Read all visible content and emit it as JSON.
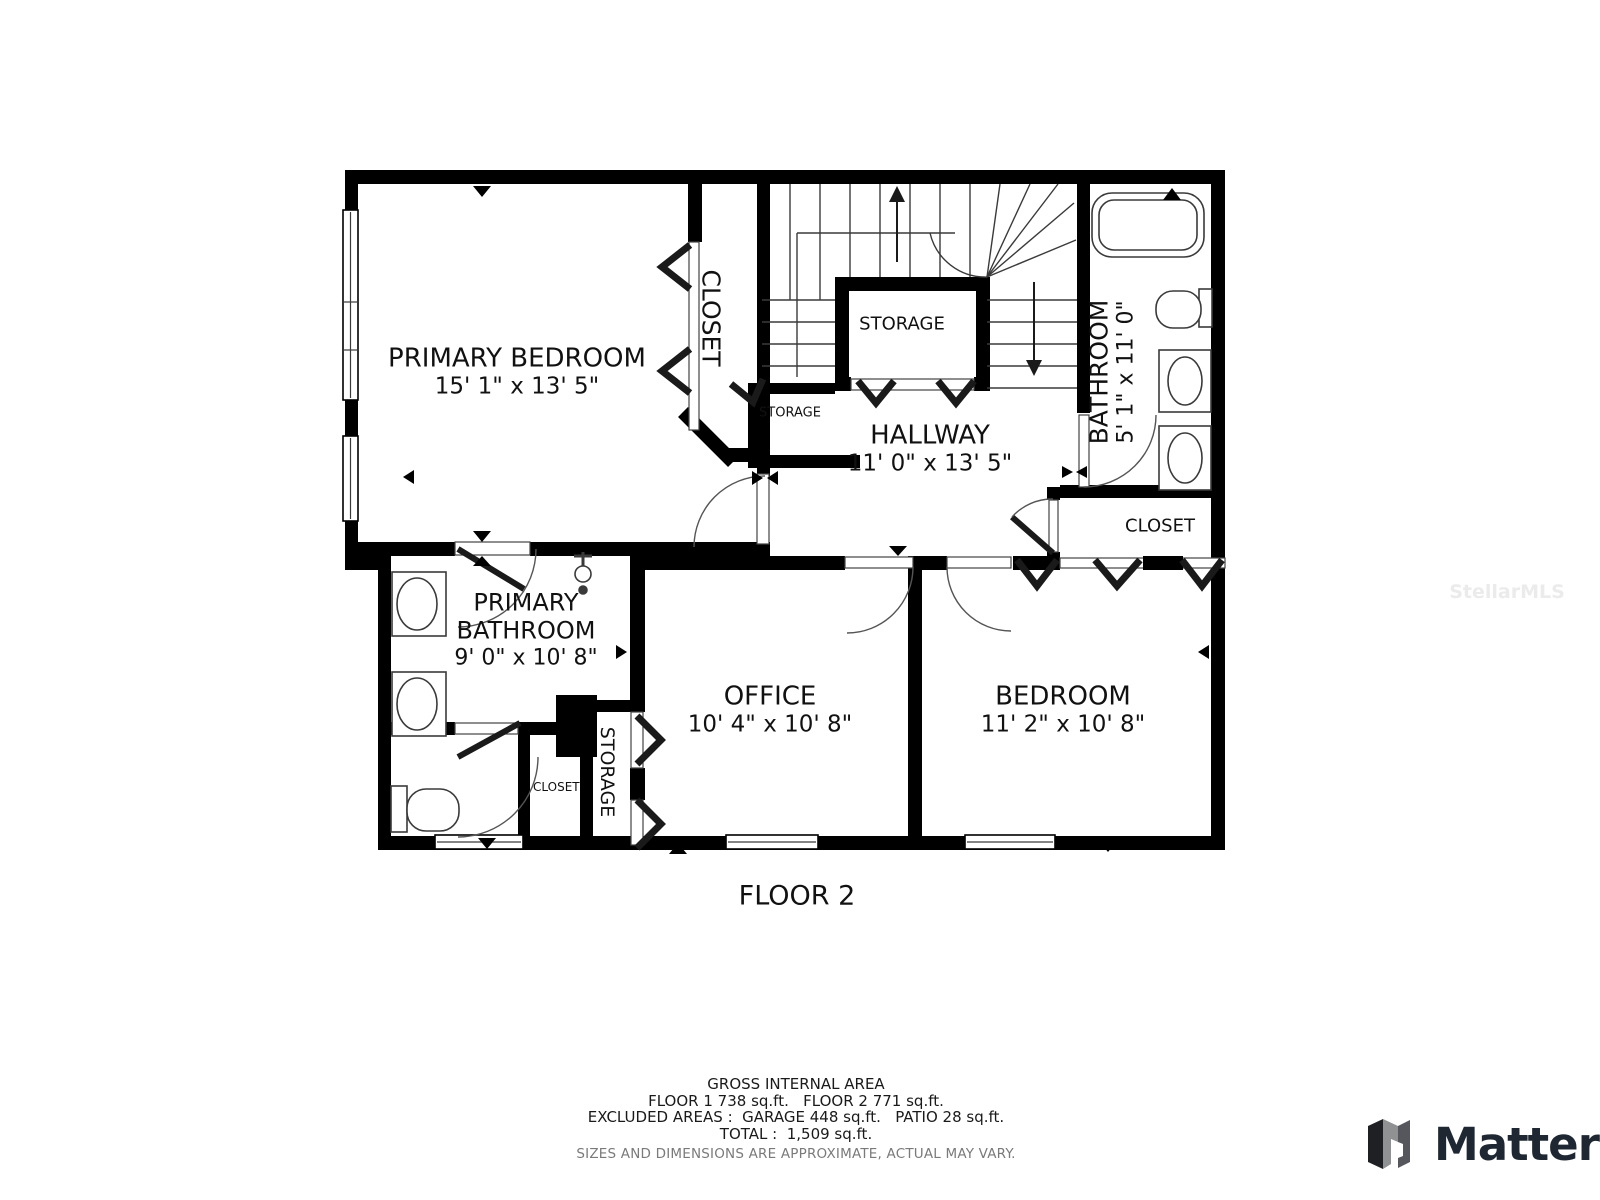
{
  "floor": {
    "label": "FLOOR 2"
  },
  "rooms": {
    "primary_bedroom": {
      "name": "PRIMARY BEDROOM",
      "dims": "15' 1\" x 13' 5\""
    },
    "closet_top": {
      "name": "CLOSET"
    },
    "storage_stairs": {
      "name": "STORAGE"
    },
    "storage_small": {
      "name": "STORAGE"
    },
    "hallway": {
      "name": "HALLWAY",
      "dims": "11' 0\" x 13' 5\""
    },
    "bathroom": {
      "name": "BATHROOM",
      "dims": "5' 1\" x 11' 0\""
    },
    "closet_bedroom": {
      "name": "CLOSET"
    },
    "primary_bathroom": {
      "name_line1": "PRIMARY",
      "name_line2": "BATHROOM",
      "dims": "9' 0\" x 10' 8\""
    },
    "closet_small": {
      "name": "CLOSET"
    },
    "storage_office": {
      "name": "STORAGE"
    },
    "office": {
      "name": "OFFICE",
      "dims": "10' 4\" x 10' 8\""
    },
    "bedroom": {
      "name": "BEDROOM",
      "dims": "11' 2\" x 10' 8\""
    }
  },
  "footer": {
    "title": "GROSS INTERNAL AREA",
    "floors": "FLOOR 1 738 sq.ft.   FLOOR 2 771 sq.ft.",
    "excluded": "EXCLUDED AREAS :  GARAGE 448 sq.ft.   PATIO 28 sq.ft.",
    "total": "TOTAL :  1,509 sq.ft.",
    "disclaimer": "SIZES AND DIMENSIONS ARE APPROXIMATE, ACTUAL MAY VARY."
  },
  "branding": {
    "logo_text": "Matterport",
    "watermark": "StellarMLS"
  },
  "colors": {
    "wall": "#000000",
    "thin_line": "#3a3a3a",
    "text": "#111111",
    "muted": "#7a7a7a",
    "watermark": "#ebebeb",
    "logo_dark": "#1f2832",
    "logo_gray": "#8f9193"
  }
}
